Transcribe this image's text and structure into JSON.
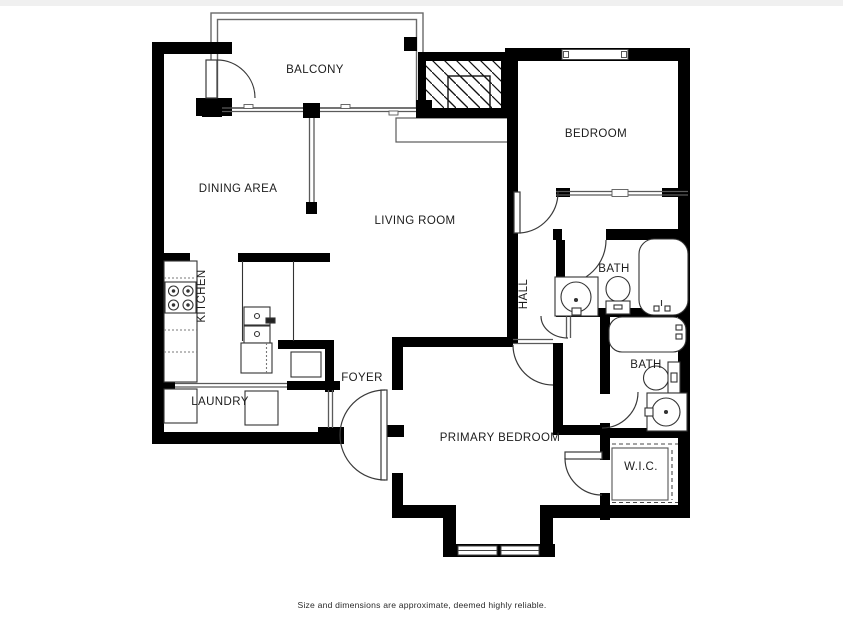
{
  "document": {
    "type": "residential-floor-plan"
  },
  "labels": {
    "balcony": "BALCONY",
    "bedroom": "BEDROOM",
    "dining": "DINING AREA",
    "living": "LIVING ROOM",
    "hall": "HALL",
    "kitchen": "KITCHEN",
    "laundry": "LAUNDRY",
    "foyer": "FOYER",
    "primary_bedroom": "PRIMARY BEDROOM",
    "bath_upper": "BATH",
    "bath_lower": "BATH",
    "wic": "W.I.C."
  },
  "footer": {
    "disclaimer": "Size and dimensions are approximate, deemed highly reliable."
  },
  "colors": {
    "walls": "#000000",
    "thin_lines": "#5a5a5a",
    "fixtures": "#333333",
    "text": "#1c1c1c",
    "background": "#ffffff"
  }
}
